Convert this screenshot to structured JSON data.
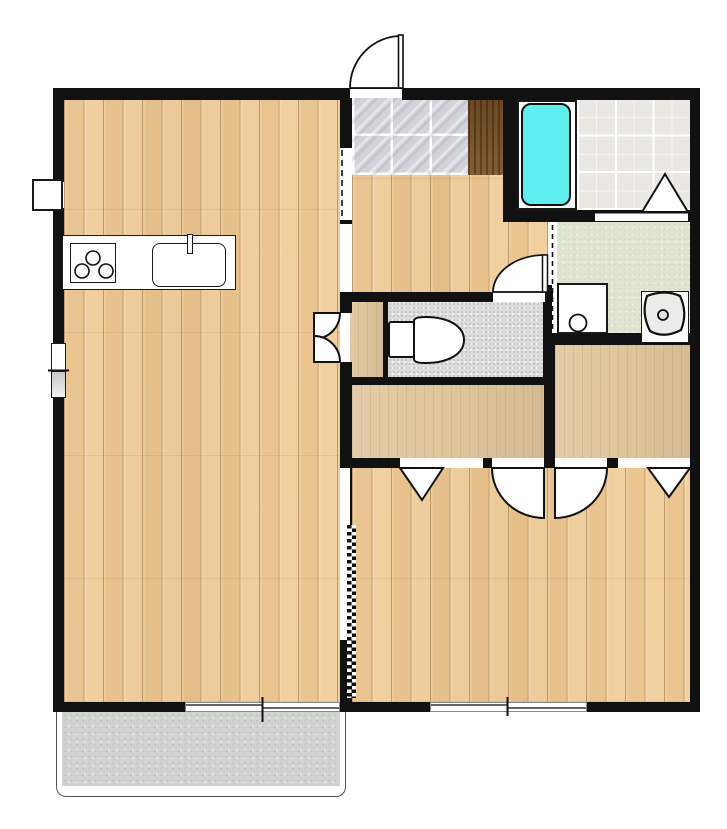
{
  "document": {
    "type": "apartment-floor-plan",
    "visible_text": []
  },
  "colors": {
    "wall": "#111111",
    "wood": "#eec994",
    "closet": "#dfc59b",
    "entry_tile": "#d3d4da",
    "entry_grout": "#ffffff",
    "step": "#7a5226",
    "bath_tile": "#eae8e2",
    "bath_grid": "#ffffff",
    "bathtub": "#5feef0",
    "washroom": "#e0e5d2",
    "toilet_floor": "#dedede",
    "balcony": "#cfd4cf",
    "fixture": "#ffffff",
    "threshold": "#ffffff"
  },
  "rooms": [
    {
      "name": "living-dining-kitchen",
      "floor": "wood"
    },
    {
      "name": "entry-genkan",
      "floor": "stone-tile"
    },
    {
      "name": "entry-step",
      "floor": "dark-wood"
    },
    {
      "name": "hallway",
      "floor": "wood"
    },
    {
      "name": "bathroom",
      "floor": "tile"
    },
    {
      "name": "washroom",
      "floor": "green-vinyl"
    },
    {
      "name": "toilet-room",
      "floor": "speckled-vinyl"
    },
    {
      "name": "side-closet",
      "floor": "plain-wood"
    },
    {
      "name": "closet-left",
      "floor": "plain-wood"
    },
    {
      "name": "closet-right",
      "floor": "plain-wood"
    },
    {
      "name": "bedroom",
      "floor": "wood"
    },
    {
      "name": "balcony",
      "floor": "concrete"
    }
  ],
  "fixtures": [
    {
      "name": "kitchen-counter"
    },
    {
      "name": "stove-three-burners"
    },
    {
      "name": "kitchen-sink-with-faucet"
    },
    {
      "name": "bathtub"
    },
    {
      "name": "washing-machine"
    },
    {
      "name": "washbasin"
    },
    {
      "name": "toilet"
    },
    {
      "name": "meter-box"
    }
  ],
  "doors": [
    {
      "name": "entry-swing-door"
    },
    {
      "name": "toilet-swing-door"
    },
    {
      "name": "side-closet-double-doors"
    },
    {
      "name": "closet-swing-door-left"
    },
    {
      "name": "closet-swing-door-right"
    },
    {
      "name": "closet-folding-door-left"
    },
    {
      "name": "closet-folding-door-right"
    },
    {
      "name": "bathroom-folding-door"
    },
    {
      "name": "accordion-partition"
    },
    {
      "name": "dashed-sliding-opening-kitchen"
    },
    {
      "name": "dashed-sliding-opening-washroom"
    }
  ],
  "windows": [
    {
      "name": "left-wall-window"
    },
    {
      "name": "living-sliding-window"
    },
    {
      "name": "bedroom-sliding-window"
    }
  ]
}
